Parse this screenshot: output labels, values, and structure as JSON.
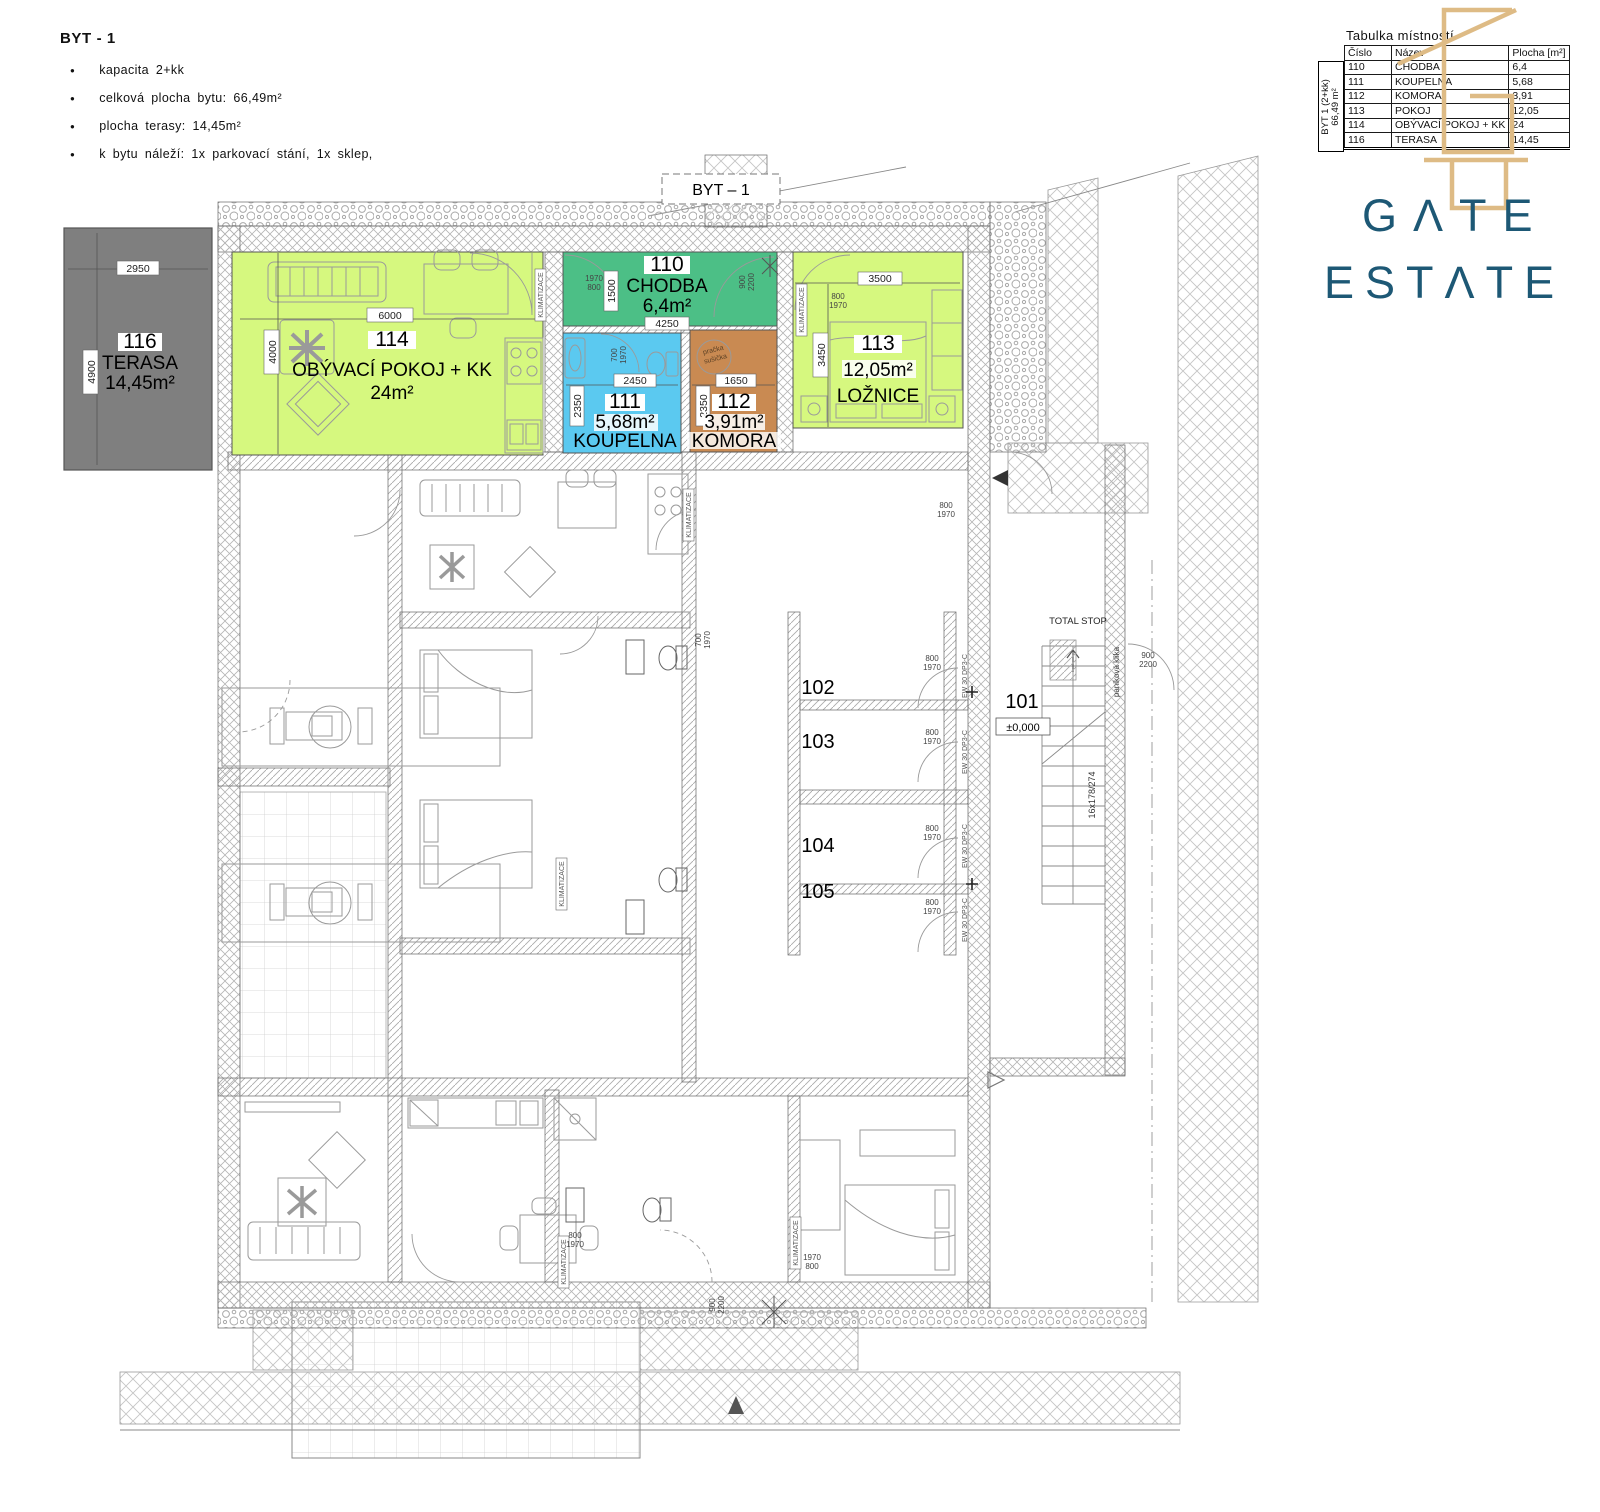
{
  "header": {
    "title": "BYT - 1",
    "bullets": [
      "kapacita 2+kk",
      "celková plocha bytu: 66,49m²",
      "plocha terasy: 14,45m²",
      "k bytu náleží: 1x parkovací stání, 1x sklep,"
    ]
  },
  "room_table": {
    "title": "Tabulka místností",
    "columns": [
      "Číslo",
      "Název",
      "Plocha [m²]"
    ],
    "side_line1": "BYT 1 (2+kk)",
    "side_line2": "66,49 m²",
    "rows": [
      {
        "cislo": "110",
        "nazev": "CHODBA",
        "plocha": "6,4"
      },
      {
        "cislo": "111",
        "nazev": "KOUPELNA",
        "plocha": "5,68"
      },
      {
        "cislo": "112",
        "nazev": "KOMORA",
        "plocha": "3,91"
      },
      {
        "cislo": "113",
        "nazev": "POKOJ",
        "plocha": "12,05"
      },
      {
        "cislo": "114",
        "nazev": "OBÝVACÍ POKOJ + KK",
        "plocha": "24"
      },
      {
        "cislo": "116",
        "nazev": "TERASA",
        "plocha": "14,45"
      }
    ]
  },
  "logo": {
    "name": "GATE ESTATE",
    "word1": "GΛTE",
    "word2": "ESTΛTE",
    "blue": "#1d5875",
    "gold": "#debb85"
  },
  "plan": {
    "unit_label": "BYT – 1",
    "colors": {
      "terrace": "#7f7f7f",
      "living": "#d6f87f",
      "hall": "#4cbf86",
      "bath": "#5bc9f0",
      "storage": "#c98a52"
    },
    "rooms": {
      "terasa": {
        "num": "116",
        "name": "TERASA",
        "area": "14,45m²",
        "dim_w": "2950",
        "dim_h": "4900"
      },
      "obyvaci": {
        "num": "114",
        "name": "OBÝVACÍ POKOJ + KK",
        "area": "24m²",
        "dim_w": "6000",
        "dim_h": "4000"
      },
      "chodba": {
        "num": "110",
        "name": "CHODBA",
        "area": "6,4m²",
        "dim_w": "4250",
        "dim_h": "1500"
      },
      "koupelna": {
        "num": "111",
        "name": "KOUPELNA",
        "area": "5,68m²",
        "dim_w": "2450",
        "dim_h": "2350"
      },
      "komora": {
        "num": "112",
        "name": "KOMORA",
        "area": "3,91m²",
        "dim_w": "1650",
        "dim_h": "2350"
      },
      "loznice": {
        "num": "113",
        "name": "LOŽNICE",
        "area": "12,05m²",
        "dim_w": "3500",
        "dim_h": "3450"
      }
    },
    "areas": {
      "n101": "101",
      "n102": "102",
      "n103": "103",
      "n104": "104",
      "n105": "105",
      "elevation": "±0,000"
    },
    "stairs": {
      "steps": "16x178/274",
      "total_stop": "TOTAL STOP",
      "panic_handle": "paniková klika"
    },
    "labels": {
      "klimatizace": "KLIMATIZACE",
      "pracka": "pračka",
      "susicka": "sušička",
      "fire_door": "EW 30 DP3-C"
    },
    "dims": {
      "d700": "700",
      "d800": "800",
      "d900": "900",
      "d1970": "1970",
      "d2200": "2200"
    }
  }
}
